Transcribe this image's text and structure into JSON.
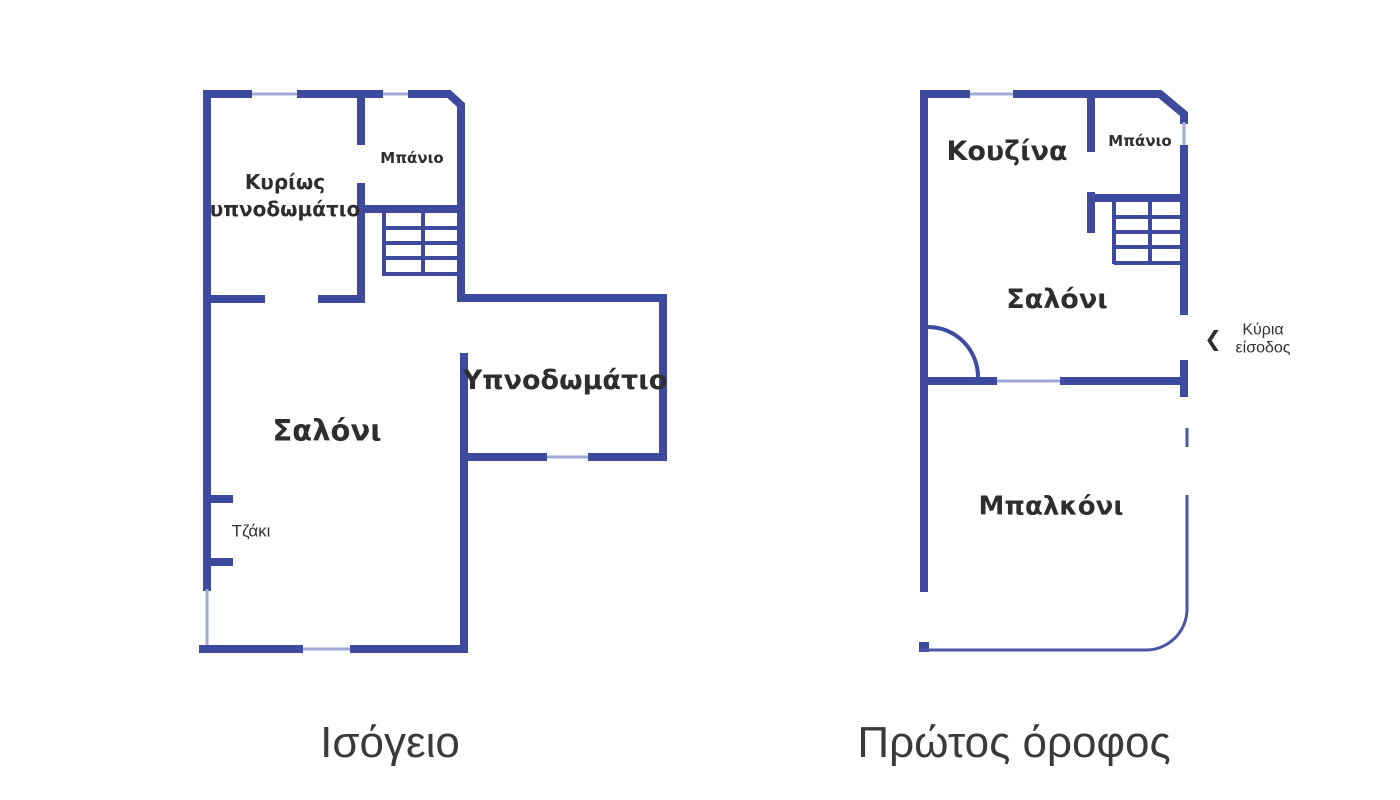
{
  "colors": {
    "wall": "#3e4a9d",
    "window": "#9fa9d4",
    "railing": "#4a56a4",
    "text": "#333333",
    "label": "#2e2e2e"
  },
  "ground_floor": {
    "title": "Ισόγειο",
    "rooms": {
      "main_bedroom": "Κυρίως υπνοδωμάτιο",
      "bathroom": "Μπάνιο",
      "living_room": "Σαλόνι",
      "bedroom": "Υπνοδωμάτιο",
      "fireplace": "Τζάκι"
    }
  },
  "first_floor": {
    "title": "Πρώτος όροφος",
    "rooms": {
      "kitchen": "Κουζίνα",
      "bathroom": "Μπάνιο",
      "living_room": "Σαλόνι",
      "balcony": "Μπαλκόνι"
    },
    "entrance": {
      "chevron": "❮",
      "label_line1": "Κύρια",
      "label_line2": "είσοδος"
    }
  }
}
